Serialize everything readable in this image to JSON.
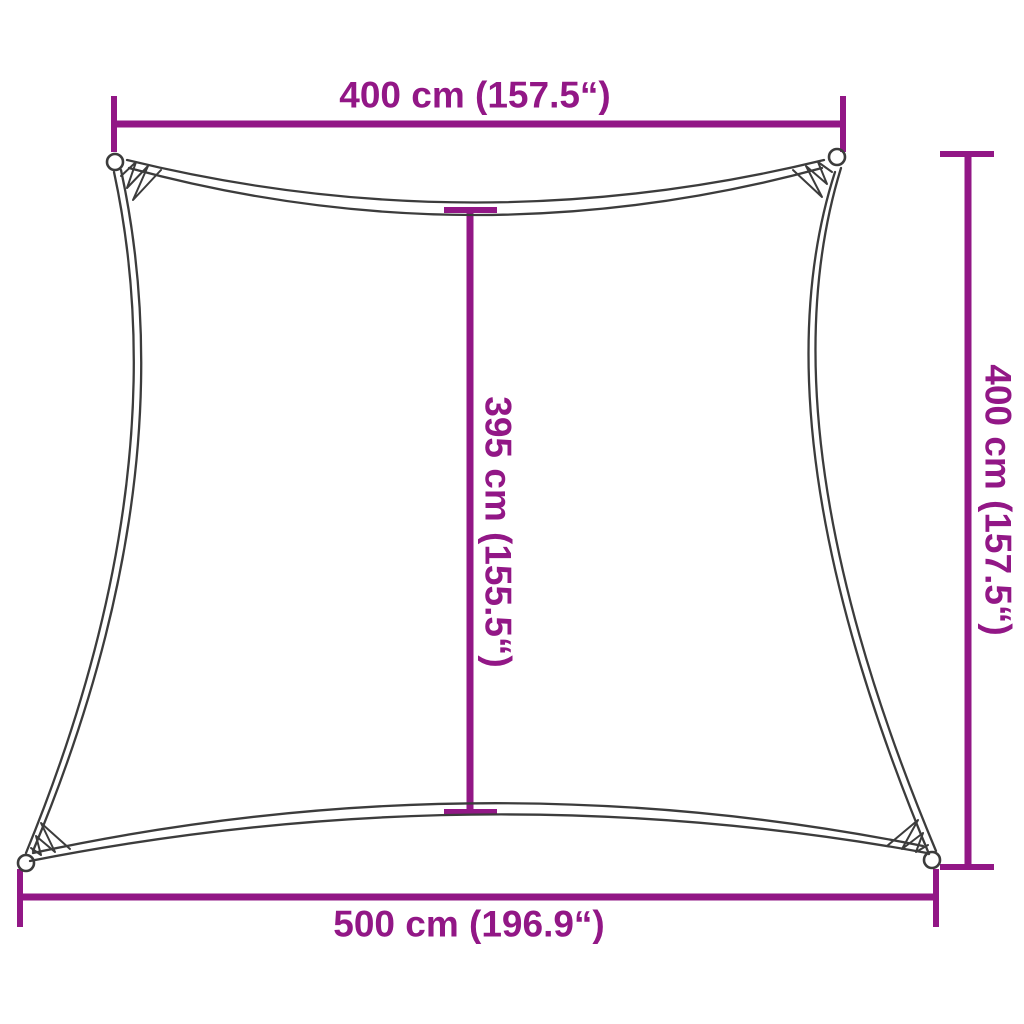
{
  "diagram": {
    "name": "Shade sail dimension diagram",
    "colors": {
      "dimension": "#921786",
      "outline": "#3C3C3C",
      "background": "#FFFFFF"
    },
    "labels": {
      "top_width": "400 cm (157.5“)",
      "right_height": "400 cm (157.5“)",
      "center_height": "395 cm (155.5“)",
      "bottom_width": "500 cm (196.9“)"
    },
    "values": {
      "top_width": {
        "cm": 400,
        "inch": 157.5
      },
      "right_height": {
        "cm": 400,
        "inch": 157.5
      },
      "center_height": {
        "cm": 395,
        "inch": 155.5
      },
      "bottom_width": {
        "cm": 500,
        "inch": 196.9
      }
    }
  }
}
